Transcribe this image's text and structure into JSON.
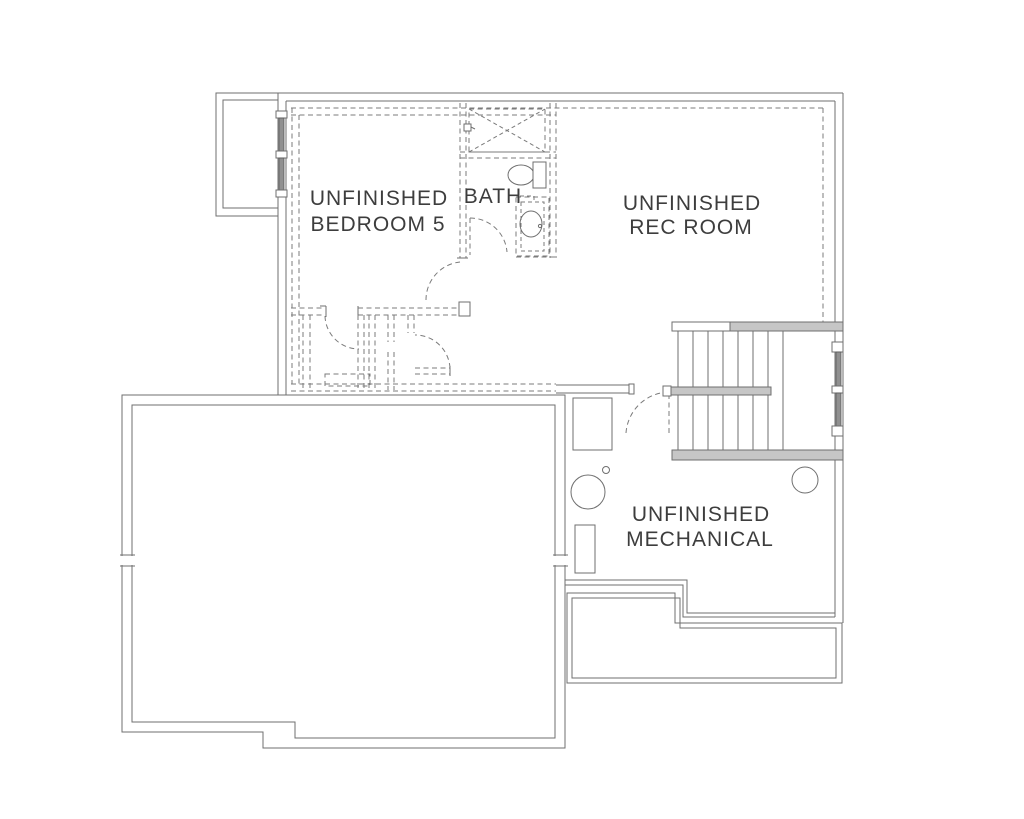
{
  "rooms": {
    "bedroom": {
      "line1": "UNFINISHED",
      "line2": "BEDROOM 5"
    },
    "bath": {
      "label": "BATH"
    },
    "rec": {
      "line1": "UNFINISHED",
      "line2": "REC ROOM"
    },
    "mech": {
      "line1": "UNFINISHED",
      "line2": "MECHANICAL"
    }
  },
  "colors": {
    "line": "#6f6f6f",
    "dashed": "#7b7b7b",
    "text": "#3d3d3d",
    "wall_fill": "#c6c6c6",
    "glazing": "#909090",
    "background": "#ffffff"
  },
  "fixtures": [
    "window-well",
    "basement-window",
    "shower",
    "shower-head",
    "toilet",
    "vanity-sink",
    "closet-walls",
    "door-swing",
    "stairs",
    "stair-handrail",
    "stair-window",
    "furnace",
    "floor-drain",
    "water-heater",
    "utility-equipment",
    "sump-circle",
    "foundation-ledge"
  ]
}
